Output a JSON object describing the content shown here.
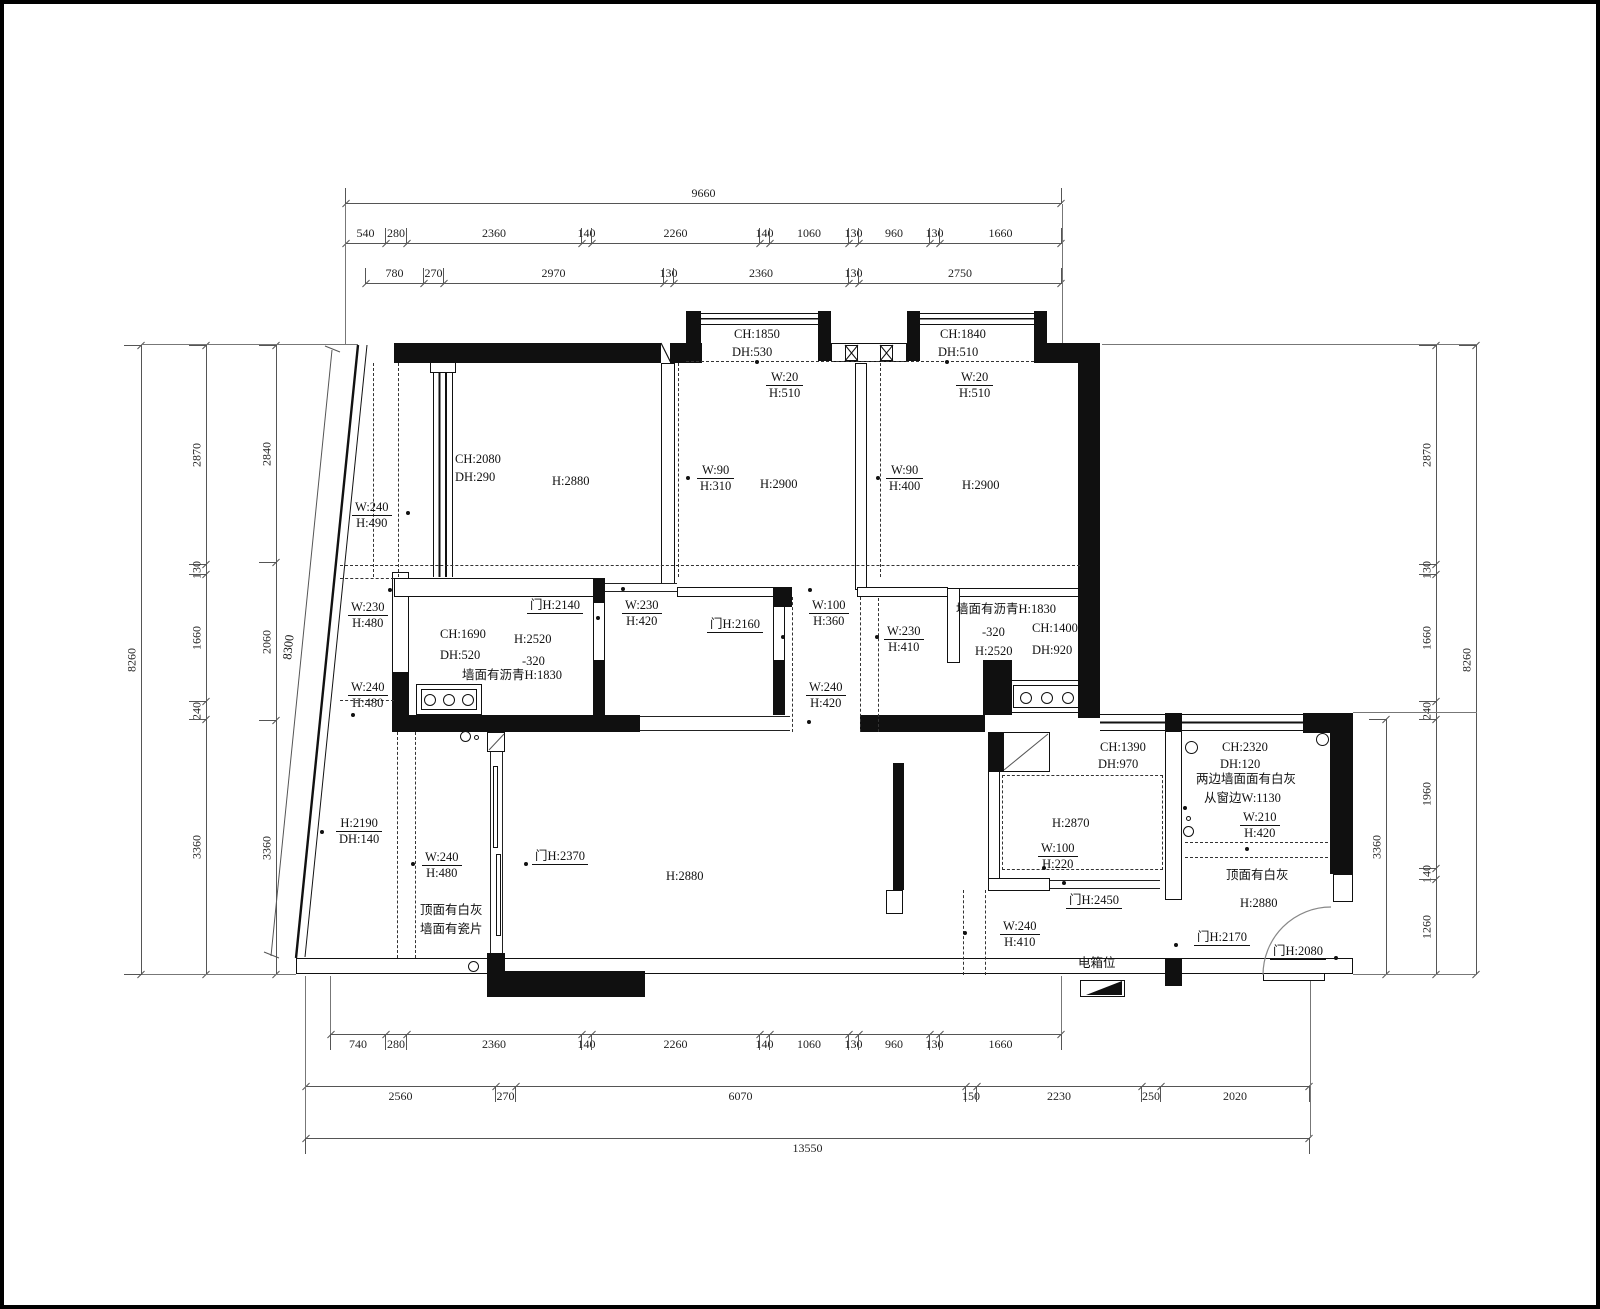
{
  "dims": {
    "top_row1": [
      "9660"
    ],
    "top_row2": [
      "540",
      "280",
      "2360",
      "140",
      "2260",
      "140",
      "1060",
      "130",
      "960",
      "130",
      "1660"
    ],
    "top_row3": [
      "780",
      "270",
      "2970",
      "130",
      "2360",
      "130",
      "2750"
    ],
    "bot_row1": [
      "740",
      "280",
      "2360",
      "140",
      "2260",
      "140",
      "1060",
      "130",
      "960",
      "130",
      "1660"
    ],
    "bot_row2": [
      "2560",
      "270",
      "6070",
      "150",
      "2230",
      "250",
      "2020"
    ],
    "bot_row3": [
      "13550"
    ],
    "left_c1": [
      "8260"
    ],
    "left_c2": [
      "2870",
      "130",
      "1660",
      "240",
      "3360"
    ],
    "left_c3": [
      "2840",
      "2060",
      "3360"
    ],
    "slant": [
      "8300"
    ],
    "right_in": [
      "3360"
    ],
    "right_c": [
      "2870",
      "130",
      "1660",
      "240",
      "1960",
      "140",
      "1260"
    ],
    "right_out": [
      "8260"
    ]
  },
  "ann": {
    "a_ch": "CH:2080",
    "a_dh": "DH:290",
    "a_h": "H:2880",
    "bay1_ch": "CH:1850",
    "bay1_dh": "DH:530",
    "bay2_ch": "CH:1840",
    "bay2_dh": "DH:510",
    "b_w20_w": "W:20",
    "b_w20_h": "H:510",
    "c_w20_w": "W:20",
    "c_w20_h": "H:510",
    "b_w90_w": "W:90",
    "b_w90_h": "H:310",
    "c_w90_w": "W:90",
    "c_w90_h": "H:400",
    "b_h": "H:2900",
    "c_h": "H:2900",
    "bal_w": "W:240",
    "bal_h": "H:490",
    "lw1_w": "W:230",
    "lw1_h": "H:480",
    "lw2_w": "W:240",
    "lw2_h": "H:480",
    "k1_ch": "CH:1690",
    "k1_dh": "DH:520",
    "k1_h": "H:2520",
    "k1_off": "-320",
    "k1_wall": "墙面有沥青H:1830",
    "d2140": "门H:2140",
    "d2160": "门H:2160",
    "d2370": "门H:2370",
    "d2450": "门H:2450",
    "d2170": "门H:2170",
    "d2080": "门H:2080",
    "mw1_w": "W:230",
    "mw1_h": "H:420",
    "mw2_w": "W:100",
    "mw2_h": "H:360",
    "mw3_w": "W:230",
    "mw3_h": "H:410",
    "mw4_w": "W:240",
    "mw4_h": "H:420",
    "k2_wall": "墙面有沥青H:1830",
    "k2_off": "-320",
    "k2_ch": "CH:1400",
    "k2_h": "H:2520",
    "k2_dh": "DH:920",
    "kit_ch": "CH:1390",
    "kit_dh": "DH:970",
    "kit_h": "H:2870",
    "kit_w100": "W:100",
    "kit_h220": "H:220",
    "lr2_w": "W:240",
    "lr2_h": "H:410",
    "ebox": "电箱位",
    "e_ch": "CH:2320",
    "e_dh": "DH:120",
    "e_wall1": "两边墙面面有白灰",
    "e_wall2": "从窗边W:1130",
    "e_w210": "W:210",
    "e_h420": "H:420",
    "e_top": "顶面有白灰",
    "e_h": "H:2880",
    "lr_h2190": "H:2190",
    "lr_dh140": "DH:140",
    "lr_w240": "W:240",
    "lr_h480": "H:480",
    "lr_top1": "顶面有白灰",
    "lr_top2": "墙面有瓷片",
    "lr_h": "H:2880"
  }
}
